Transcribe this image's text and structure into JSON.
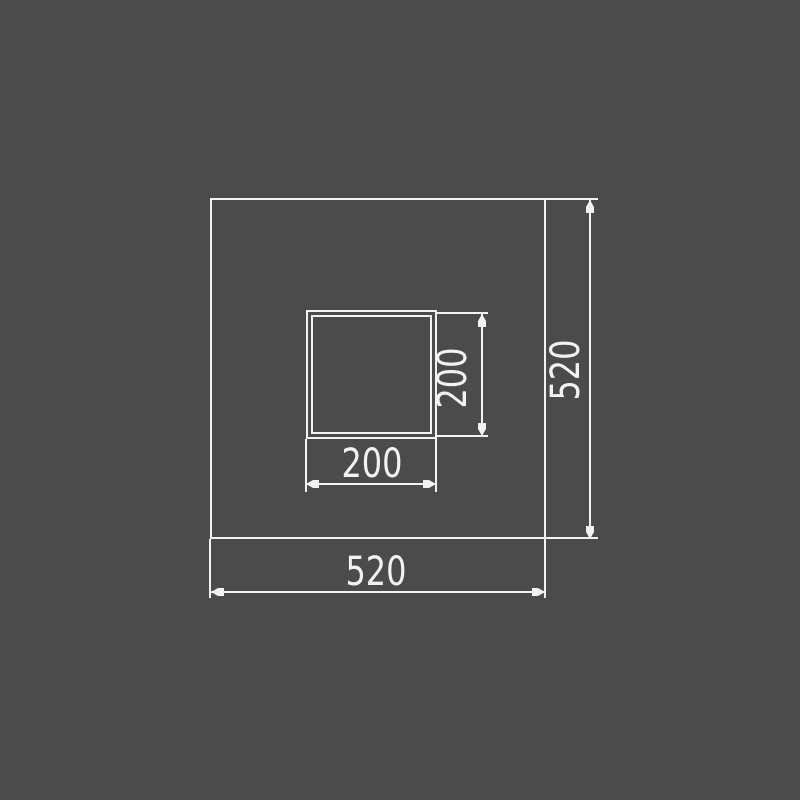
{
  "drawing": {
    "colors": {
      "background": "#4b4b4b",
      "line": "#f2f2f2"
    },
    "shapes": {
      "outer_square": {
        "width": "520",
        "height": "520"
      },
      "inner_square": {
        "width": "200",
        "height": "200"
      }
    },
    "dimensions": {
      "outer_width_label": "520",
      "outer_height_label": "520",
      "inner_width_label": "200",
      "inner_height_label": "200"
    }
  }
}
